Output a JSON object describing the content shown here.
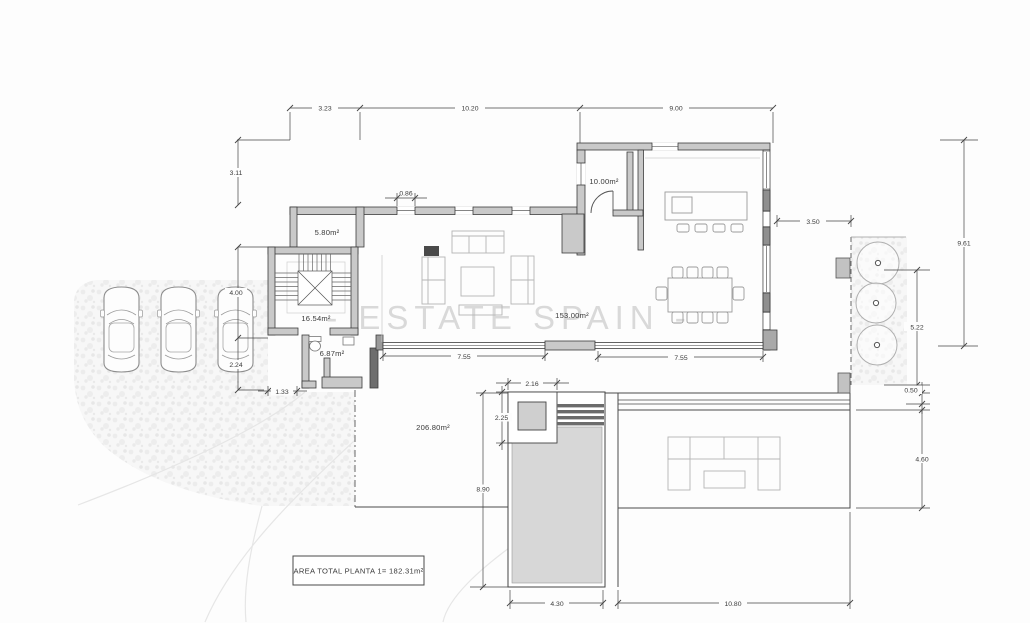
{
  "watermark": "- ESTATE SPAIN -",
  "summary_box": {
    "text": "AREA TOTAL PLANTA 1= 182.31m²"
  },
  "rooms": {
    "storage": "5.80m²",
    "pantry": "10.00m²",
    "stairwell": "16.54m²",
    "bathroom": "6.87m²",
    "living_dining": "153.00m²",
    "exterior_terrace": "206.80m²"
  },
  "dimensions": {
    "top_left": "3.23",
    "top_mid": "10.20",
    "top_right": "9.00",
    "left_upper": "3.11",
    "left_mid": "4.00",
    "left_lower": "2.24",
    "porch_width": "1.33",
    "window_width": "0.86",
    "slider_left": "7.55",
    "slider_right": "7.55",
    "side_gap": "3.50",
    "right_total": "9.61",
    "right_strip": "5.22",
    "right_step": "0.50",
    "terrace_depth": "4.60",
    "spa_width": "2.16",
    "spa_height": "2.25",
    "pool_side": "8.90",
    "pool_width": "4.30",
    "terrace_width": "10.80"
  }
}
